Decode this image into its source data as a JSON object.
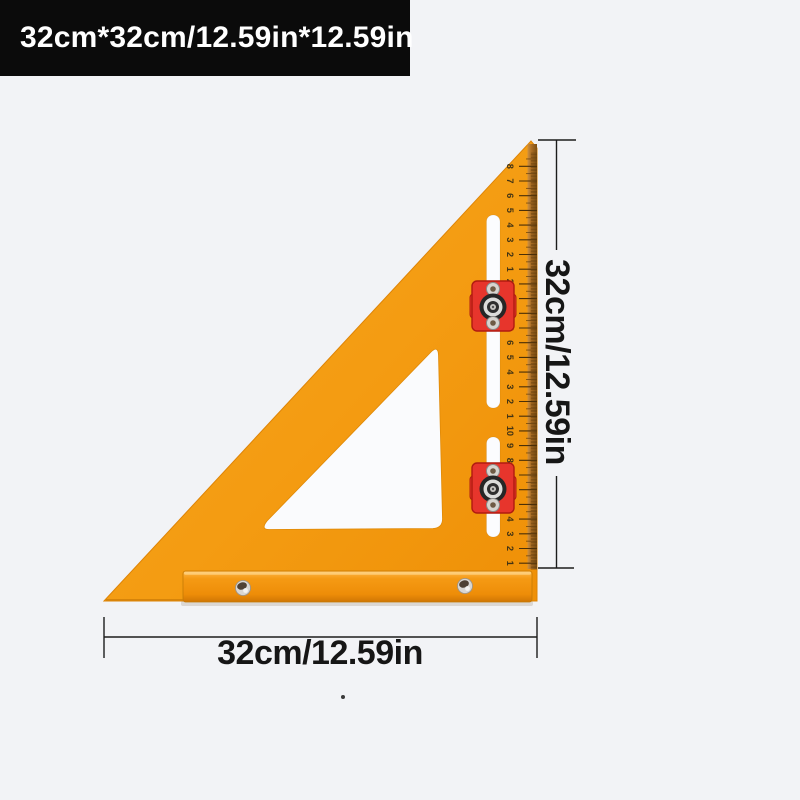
{
  "page": {
    "background": "#f2f3f6"
  },
  "badge": {
    "label": "32cm*32cm/12.59in*12.59in",
    "background": "#0b0b0b",
    "text_color": "#ffffff"
  },
  "product": {
    "type": "orange carpenter triangle square ruler with red sliding clamps",
    "body_color": "#f49e16",
    "edge_strip_color": "#9a6420",
    "slot_color": "#fafbfd",
    "clamp_color": "#e7352c",
    "base_bar_color": "#f0930d"
  },
  "ruler": {
    "marks": [
      "1",
      "2",
      "3",
      "4",
      "5",
      "6",
      "7",
      "8",
      "9",
      "10",
      "1",
      "2",
      "3",
      "4",
      "5",
      "6",
      "7",
      "8",
      "9",
      "20",
      "1",
      "2",
      "3",
      "4",
      "5",
      "6",
      "7",
      "8"
    ]
  },
  "annotations": {
    "vertical_label": "32cm/12.59in",
    "horizontal_label": "32cm/12.59in",
    "line_color": "#1c1c1c",
    "label_color": "#161616"
  }
}
